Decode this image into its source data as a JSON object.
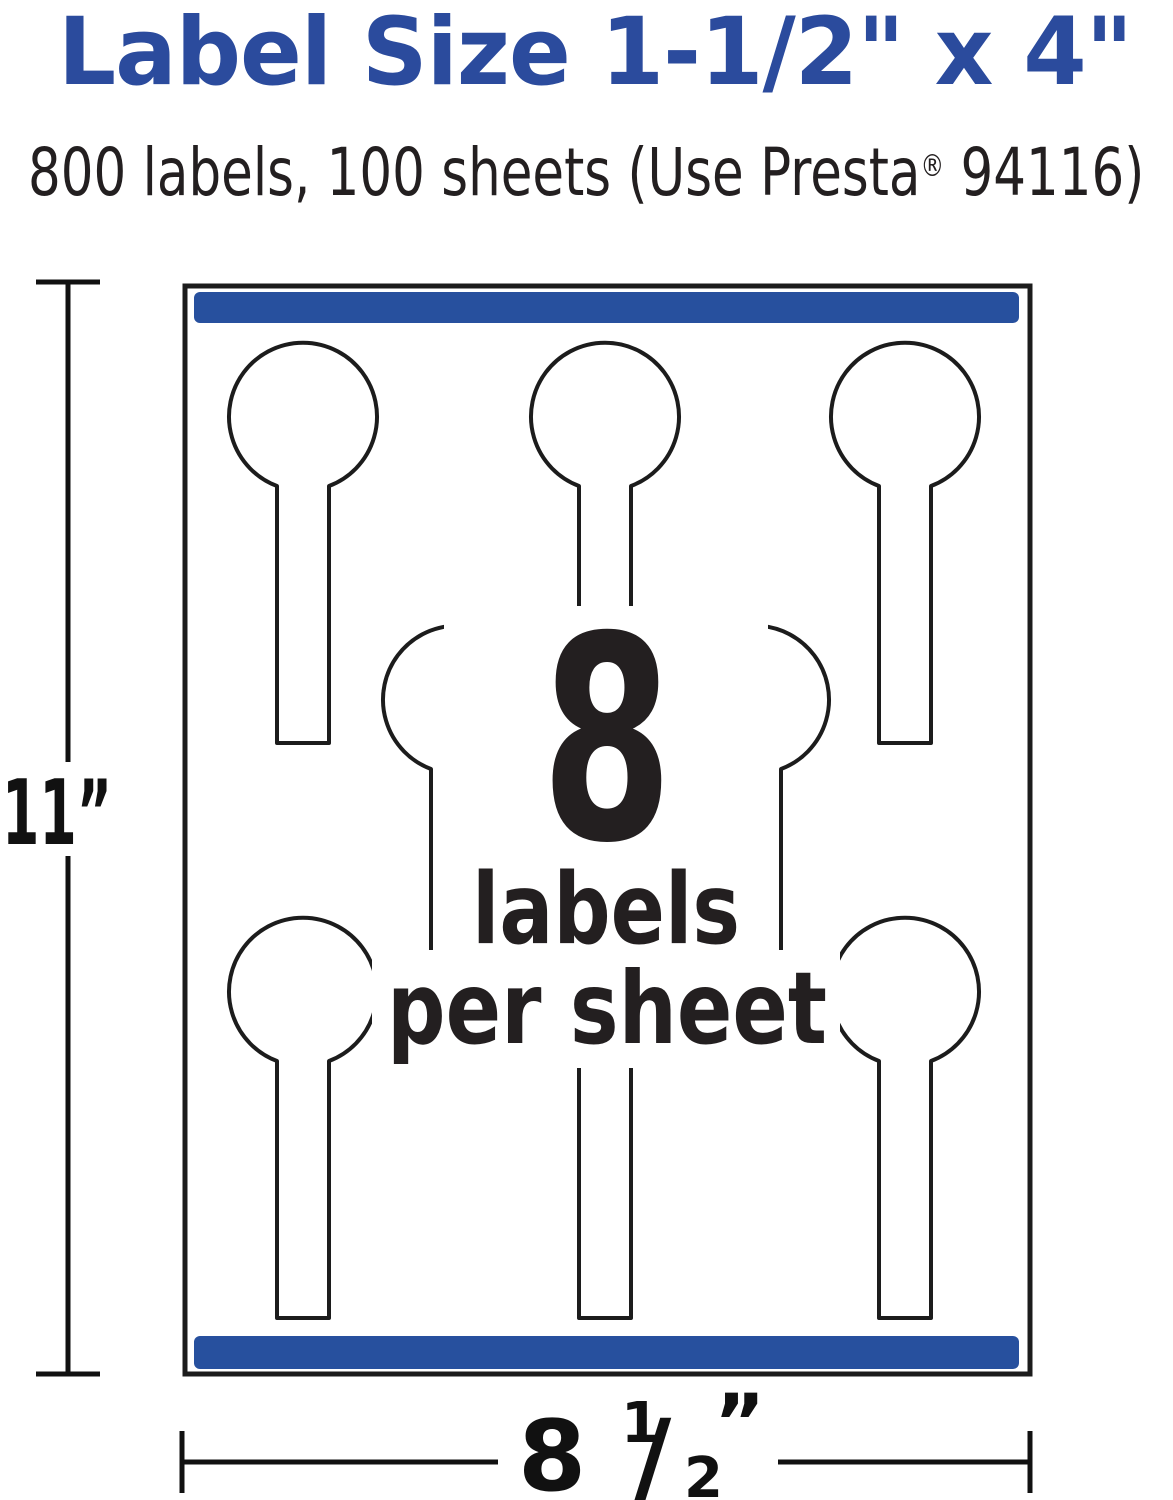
{
  "header": {
    "title": "Label Size 1-1/2\" x 4\"",
    "title_color": "#2b4b9d",
    "text_color": "#231f20",
    "subtitle": {
      "pre": "800 labels, 100 sheets (Use Presta",
      "trademark": "®",
      "post": " 94116)"
    }
  },
  "diagram": {
    "sheet": {
      "border_color": "#1c1c1c",
      "bar_color": "#27509e",
      "label_outline_color": "#1c1c1c",
      "labels_per_row": [
        3,
        2,
        3
      ]
    },
    "callout": {
      "count": "8",
      "line1": "labels",
      "line2": "per sheet"
    }
  },
  "dimensions": {
    "height_label": "11”",
    "width_label": {
      "whole": "8",
      "numerator": "1",
      "slash": "/",
      "denominator": "2",
      "unit": "”"
    }
  }
}
